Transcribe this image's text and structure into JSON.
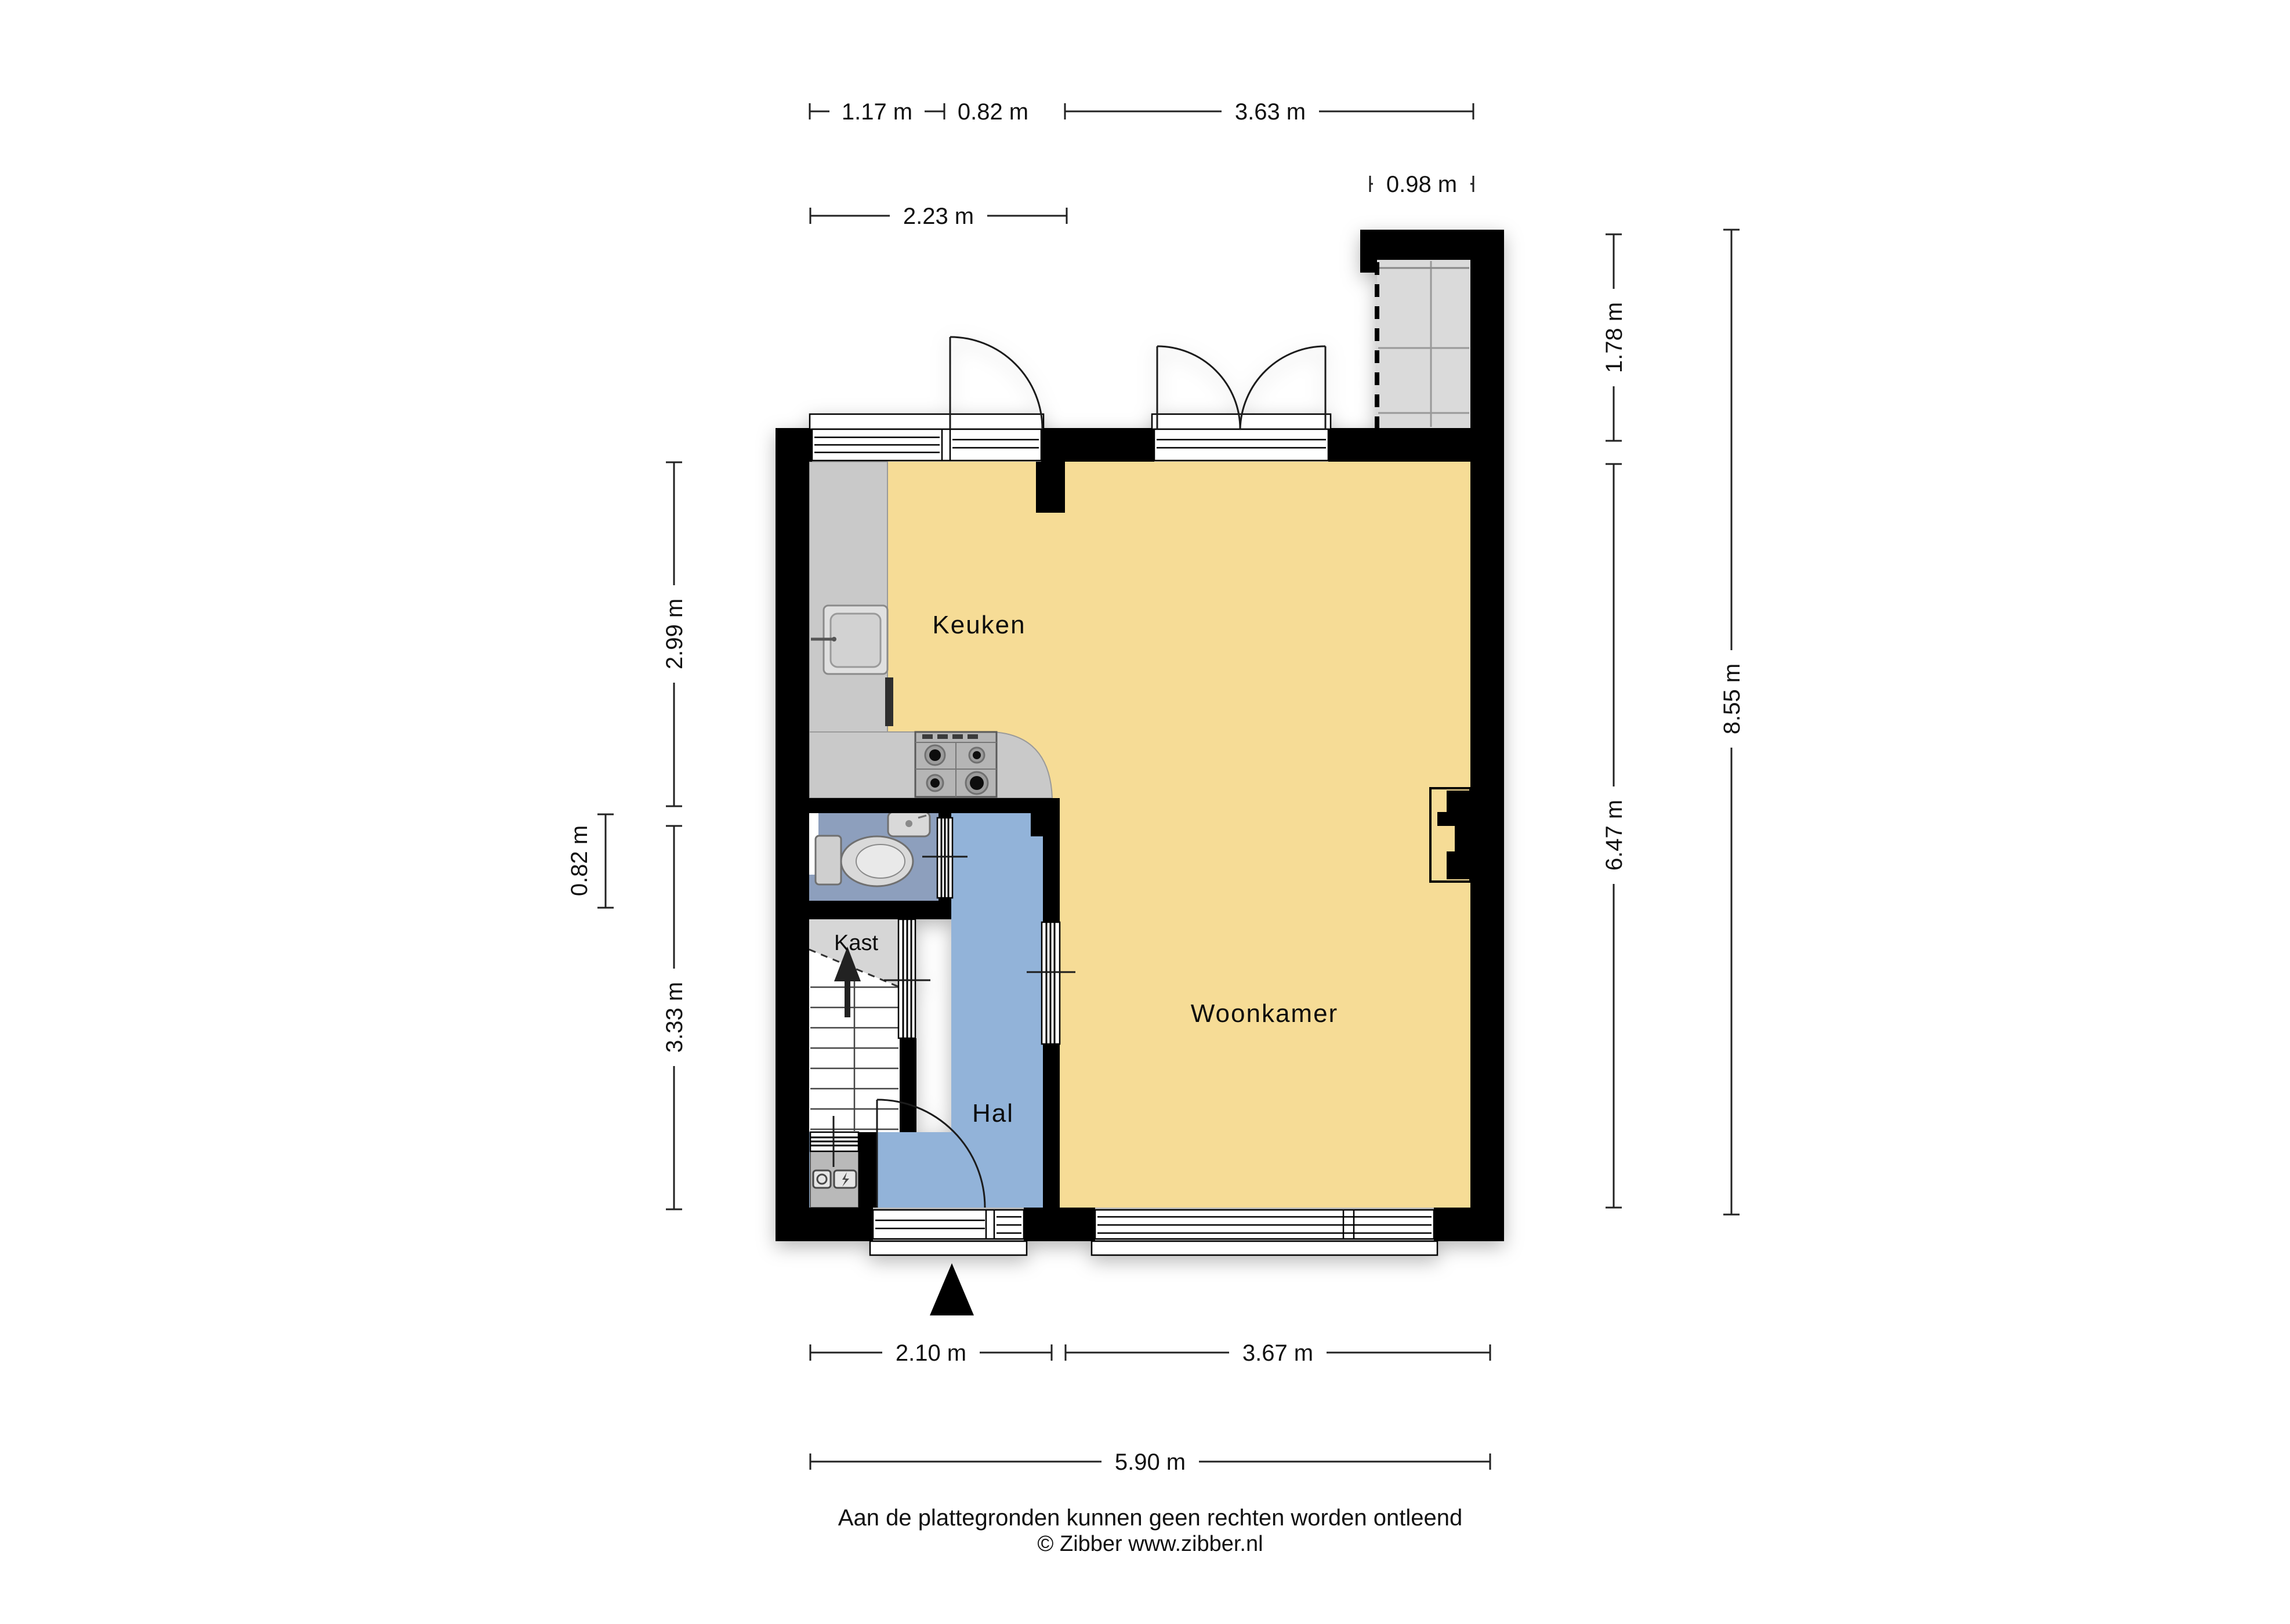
{
  "floorplan": {
    "rooms": {
      "kitchen": "Keuken",
      "living_room": "Woonkamer",
      "hall": "Hal",
      "closet": "Kast"
    },
    "dimensions": {
      "top_window": "1.17 m",
      "top_door": "0.82 m",
      "top_living": "3.63 m",
      "top_kitchen_total": "2.23 m",
      "extension_width": "0.98 m",
      "extension_height": "1.78 m",
      "right_inner": "6.47 m",
      "right_total": "8.55 m",
      "left_kitchen": "2.99 m",
      "left_hall": "3.33 m",
      "left_toilet": "0.82 m",
      "bottom_hall": "2.10 m",
      "bottom_living": "3.67 m",
      "bottom_total": "5.90 m"
    },
    "footer": {
      "disclaimer": "Aan de plattegronden kunnen geen rechten worden ontleend",
      "copyright": "© Zibber www.zibber.nl"
    },
    "colors": {
      "floor": "#f6dc96",
      "hall": "#92b3d9",
      "toilet": "#8d9fbd",
      "counter": "#c9c9c9",
      "stove": "#b5b5b5",
      "extension": "#dadada",
      "closet": "#d6d6d6",
      "wall": "#000000"
    }
  }
}
